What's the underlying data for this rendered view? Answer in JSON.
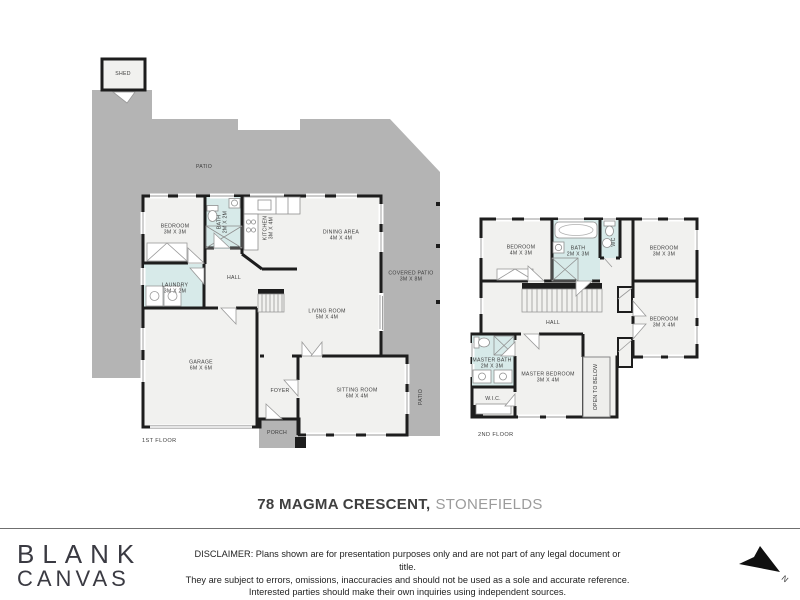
{
  "floor1": {
    "floor_label": "1ST FLOOR",
    "shed": {
      "name": "SHED"
    },
    "patio_top": {
      "name": "PATIO"
    },
    "bedroom": {
      "name": "BEDROOM",
      "dims": "3M X 3M"
    },
    "bath": {
      "name": "BATH",
      "dims": "2M X 2M"
    },
    "kitchen": {
      "name": "KITCHEN",
      "dims": "3M X 4M"
    },
    "dining": {
      "name": "DINING AREA",
      "dims": "4M X 4M"
    },
    "covered_patio": {
      "name": "COVERED PATIO",
      "dims": "3M X 8M"
    },
    "hall": {
      "name": "HALL"
    },
    "laundry": {
      "name": "LAUNDRY",
      "dims": "3M X 2M"
    },
    "living": {
      "name": "LIVING ROOM",
      "dims": "5M X 4M"
    },
    "garage": {
      "name": "GARAGE",
      "dims": "6M X 6M"
    },
    "foyer": {
      "name": "FOYER"
    },
    "sitting": {
      "name": "SITTING ROOM",
      "dims": "6M X 4M"
    },
    "porch": {
      "name": "PORCH"
    },
    "patio_side": {
      "name": "PATIO"
    }
  },
  "floor2": {
    "floor_label": "2ND FLOOR",
    "bedroom1": {
      "name": "BEDROOM",
      "dims": "4M X 3M"
    },
    "bath": {
      "name": "BATH",
      "dims": "2M X 3M"
    },
    "wc": {
      "name": "WC"
    },
    "bedroom2": {
      "name": "BEDROOM",
      "dims": "3M X 3M"
    },
    "hall": {
      "name": "HALL"
    },
    "bedroom3": {
      "name": "BEDROOM",
      "dims": "3M X 4M"
    },
    "master_bath": {
      "name": "MASTER BATH",
      "dims": "2M X 3M"
    },
    "wic": {
      "name": "W.I.C."
    },
    "master_bedroom": {
      "name": "MASTER BEDROOM",
      "dims": "3M X 4M"
    },
    "open_below": {
      "name": "OPEN TO BELOW"
    }
  },
  "title": {
    "address": "78 MAGMA CRESCENT,",
    "suburb": "STONEFIELDS"
  },
  "brand": {
    "line1": "BLANK",
    "line2": "CANVAS"
  },
  "disclaimer": {
    "line1": "DISCLAIMER: Plans shown are for presentation purposes only and are not part of any legal document or title.",
    "line2": "They are subject to errors, omissions, inaccuracies and should not be used as a sole and accurate reference.",
    "line3": "Interested parties should make their own inquiries using independent sources."
  },
  "compass": {
    "label": "N"
  },
  "colors": {
    "patio": "#b4b4b4",
    "room_fill": "#f1f1ef",
    "wet_fill": "#d7eae9",
    "wall": "#1d1d1d",
    "title_text": "#3f3f3f",
    "suburb_text": "#9b9b9b"
  }
}
